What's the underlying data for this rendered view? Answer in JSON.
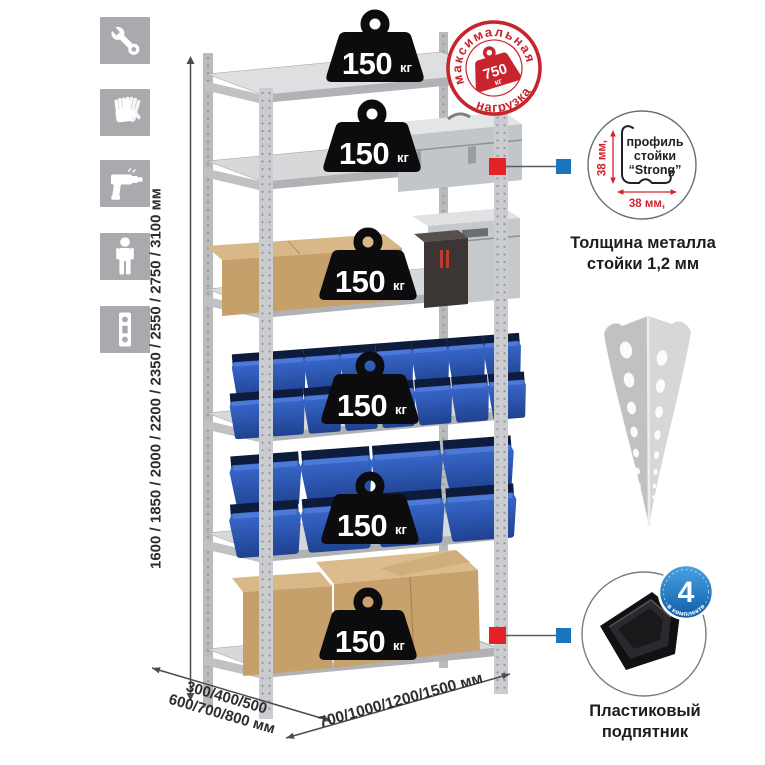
{
  "colors": {
    "stamp_red": "#c8242e",
    "callout_red": "#e32127",
    "callout_blue": "#1b74bc",
    "badge_blue": "#1b76c4",
    "bin_blue": "#2f5cb5",
    "metal_gray": "#c6c8ca",
    "icon_gray": "#a8aaad"
  },
  "sidebar": {
    "icons": [
      {
        "name": "wrench-icon"
      },
      {
        "name": "gloves-icon"
      },
      {
        "name": "drill-icon"
      },
      {
        "name": "person-icon"
      },
      {
        "name": "profile-strip-icon"
      }
    ]
  },
  "rack": {
    "weights": [
      {
        "value": "150",
        "unit": "кг"
      },
      {
        "value": "150",
        "unit": "кг"
      },
      {
        "value": "150",
        "unit": "кг"
      },
      {
        "value": "150",
        "unit": "кг"
      },
      {
        "value": "150",
        "unit": "кг"
      },
      {
        "value": "150",
        "unit": "кг"
      }
    ]
  },
  "stamp": {
    "arc_top": "максимальная",
    "arc_bottom": "нагрузка",
    "value": "750",
    "unit": "кг"
  },
  "dimensions": {
    "height": "1600 / 1850 / 2000 / 2200 / 2350 / 2550 / 2750 / 3100 мм",
    "depth_line1": "300/400/500",
    "depth_line2": "600/700/800 мм",
    "width": "700/1000/1200/1500 мм"
  },
  "profile_detail": {
    "label_line1": "профиль",
    "label_line2": "стойки",
    "label_line3": "“Strong”",
    "dim_vertical": "38 мм,",
    "dim_horizontal": "38 мм,",
    "caption_line1": "Толщина металла",
    "caption_line2": "стойки 1,2 мм"
  },
  "foot_detail": {
    "badge_number": "4",
    "badge_arc_text": "в комплекте",
    "caption_line1": "Пластиковый",
    "caption_line2": "подпятник"
  }
}
